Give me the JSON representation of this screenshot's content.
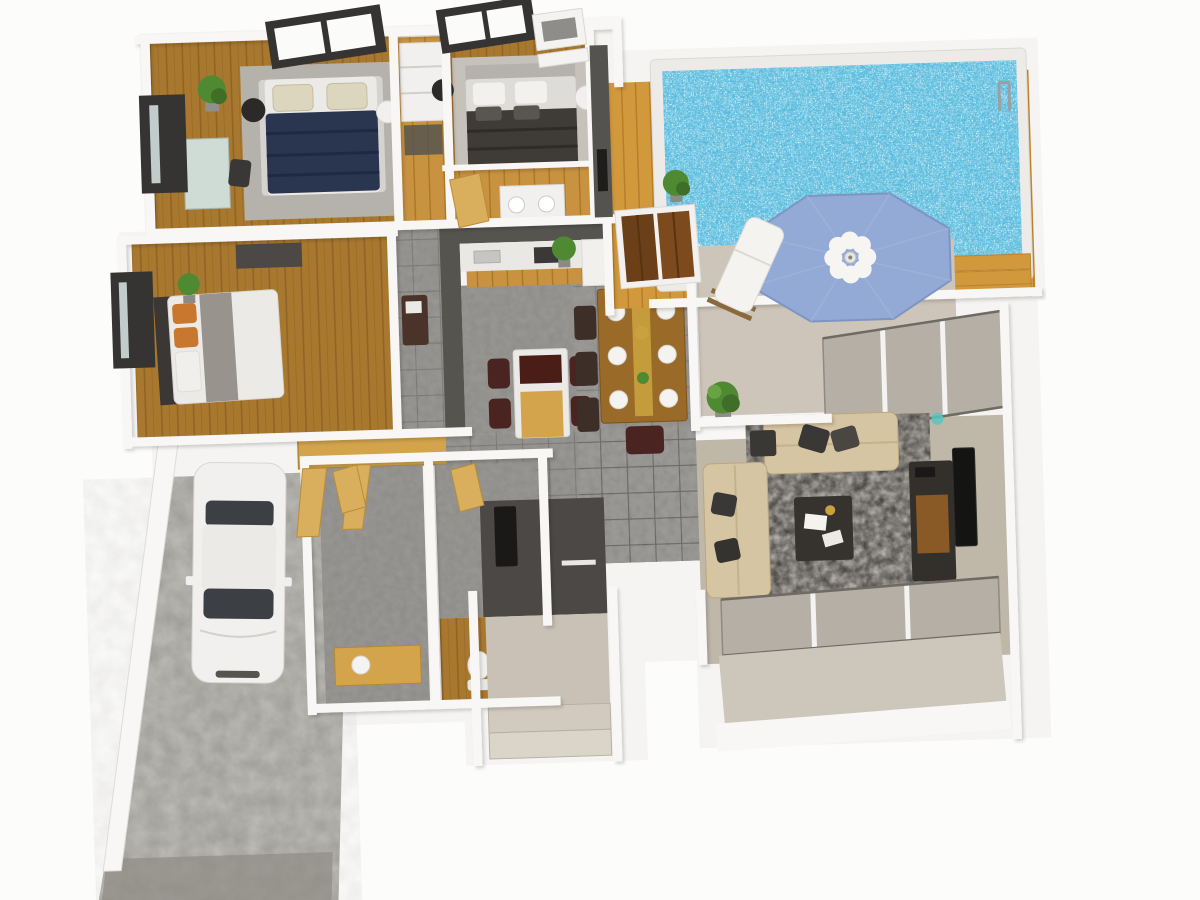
{
  "meta": {
    "description": "3D isometric rendering of a single-story house floor plan with swimming pool, three bedrooms, kitchen, dining area, living room, bathrooms, entry porch and driveway with a parked white car",
    "canvas_width": 1200,
    "canvas_height": 900
  },
  "palette": {
    "background": "#fcfcfb",
    "slab_white": "#f5f4f2",
    "wall_white": "#f8f7f5",
    "wood_floor": "#a8782f",
    "wood_floor_line": "#8f6426",
    "wood_light": "#c89240",
    "wood_light_line": "#a87828",
    "wood_deck": "#d2983c",
    "wood_deck_line": "#b67e28",
    "door_tan": "#d9ae5c",
    "cabinet_gold": "#d3a44c",
    "tile_gray": "#8e8c88",
    "concrete": "#9c9a94",
    "concrete_dark": "#8e8c85",
    "rug_gray": "#b5b2ac",
    "rug_light": "#c6c2bb",
    "rug_living": "#45423e",
    "pool_water": "#53b9dc",
    "pool_coping": "#ecebe7",
    "umbrella_blue": "#93a9d6",
    "patio_taupe": "#cdc5b9",
    "porch_taupe": "#c9c1b5",
    "terrace_taupe": "#cdc6ba",
    "living_floor": "#bfb7a7",
    "charcoal": "#4b4845",
    "kitchen_gray": "#56544f",
    "counter_white": "#e9e8e4",
    "stool_maroon": "#4a2420",
    "chair_brown": "#3d2f27",
    "dining_wood": "#9a6a28",
    "runner_gold": "#c9a23e",
    "chair_dark": "#3a3836",
    "sofa_beige": "#d6c5a2",
    "table_dark": "#36332f",
    "console_dark": "#33302c",
    "console_wood": "#8a5a26",
    "tv_black": "#141413",
    "bed_navy": "#2a3550",
    "bed_charcoal": "#3f3c38",
    "mattress_white": "#eceae6",
    "pillow_beige": "#ddd6be",
    "pillow_orange": "#c9762e",
    "headboard_gray": "#b5b2ae",
    "headboard_dark": "#3a3734",
    "window_dark": "#353432",
    "glass_green": "#cfdcd6",
    "glass_gray": "#b5afa5",
    "plant_green": "#4f8a33",
    "plant_dark": "#3e6e28",
    "car_white": "#f1f0ee",
    "car_glass": "#3c4044",
    "fixture_white": "#f1f0ee",
    "lamp_dark": "#2c2a28"
  },
  "scene": {
    "view": "top-down 3D axonometric, slight counter-clockwise tilt",
    "rooms": [
      "master-bedroom",
      "bedroom-2",
      "bedroom-3",
      "walk-in-closet",
      "hall-bathroom",
      "kitchen",
      "dining-area",
      "hallway",
      "bathroom-1",
      "bathroom-2",
      "living-room",
      "covered-patio",
      "pool-deck",
      "swimming-pool",
      "entry-porch",
      "driveway",
      "garage-corridor"
    ],
    "furniture_counts": {
      "beds": 3,
      "dining_place_settings": 6,
      "dining_chairs": 8,
      "kitchen_stools": 4,
      "sofas": 2,
      "lounge_chairs": 1,
      "potted_plants": 5
    },
    "features": {
      "pool": "rectangular pool with sparkling blue water, white coping, ladder on right edge, wooden deck",
      "umbrella": "octagonal blue patio umbrella with white flower hub",
      "car": "white sedan parked on gray concrete driveway",
      "windows": "dark-framed windows on top and left walls, large glass sliders on living room walls"
    }
  }
}
